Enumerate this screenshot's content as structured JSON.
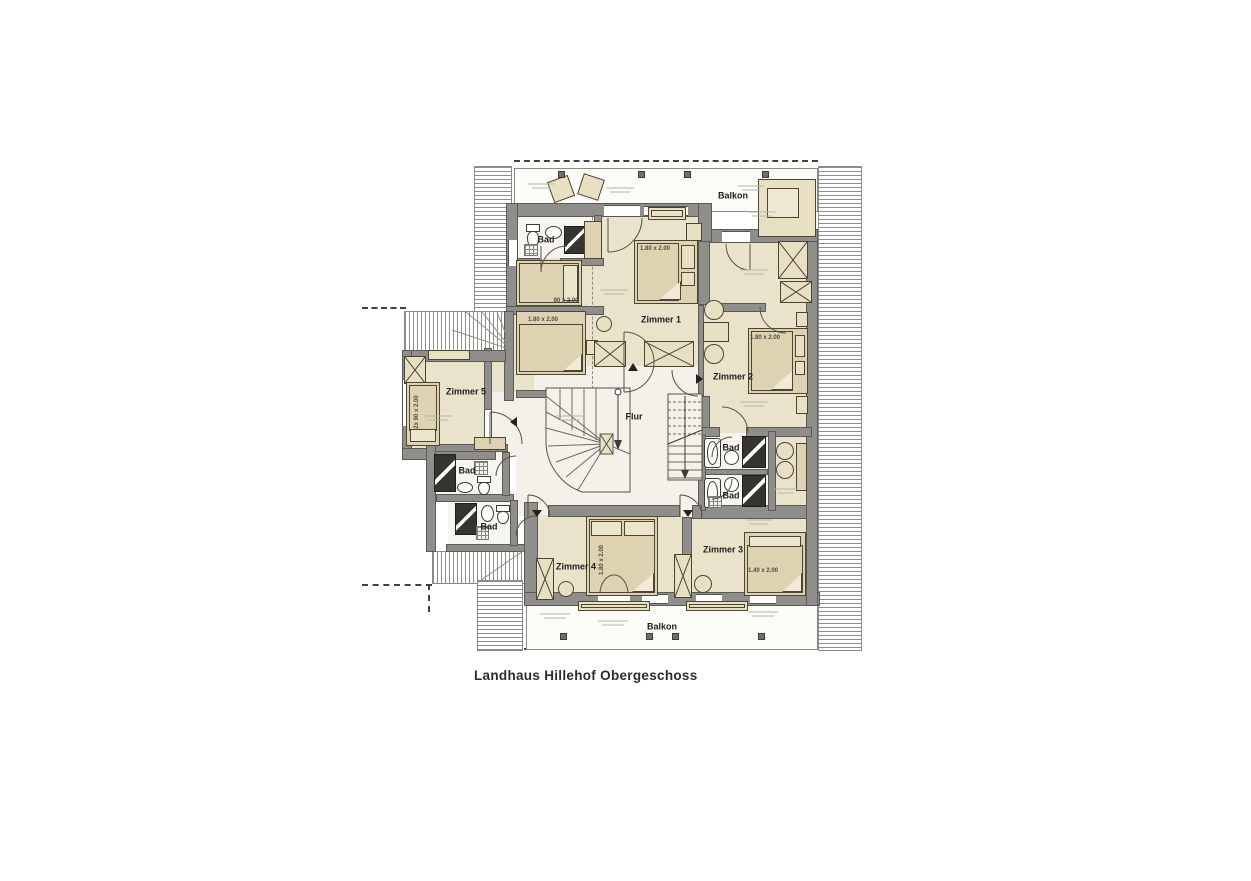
{
  "title": "Landhaus Hillehof Obergeschoss",
  "rooms": {
    "balkon_top": "Balkon",
    "balkon_bottom": "Balkon",
    "flur": "Flur",
    "zimmer1": "Zimmer 1",
    "zimmer2": "Zimmer 2",
    "zimmer3": "Zimmer 3",
    "zimmer4": "Zimmer 4",
    "zimmer5": "Zimmer 5",
    "bad_top_left": "Bad",
    "bad_left_upper": "Bad",
    "bad_left_lower": "Bad",
    "bad_right_upper": "Bad",
    "bad_right_lower": "Bad"
  },
  "bed_dimensions": {
    "zimmer1_bed": "1.80 x 2.00",
    "zimmer1_single_bed": "90 x 2.00",
    "zimmer1_alcove_bed": "1.80 x 2.00",
    "zimmer2_bed": "1.80 x 2.00",
    "zimmer3_bed": "1.40 x 2.00",
    "zimmer4_bed": "1.80 x 2.00",
    "zimmer5_bed": "2x 90 x 2.00"
  },
  "colors": {
    "wall": "#8F8E8A",
    "room_floor": "#EAE3CB",
    "hall_floor": "#F3F1E9",
    "furniture": "#DDD3B2",
    "outline": "#4C4533"
  }
}
